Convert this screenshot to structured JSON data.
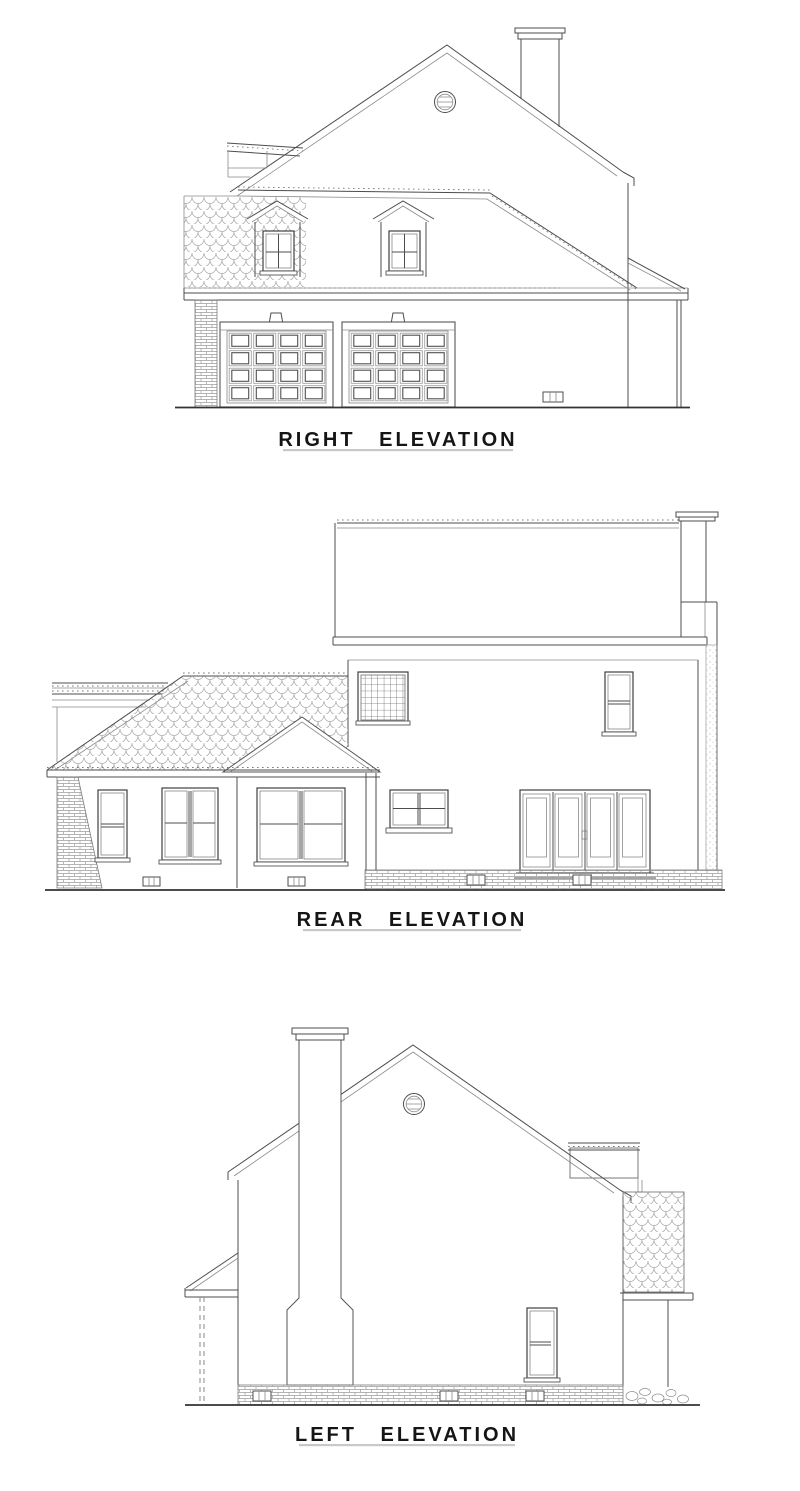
{
  "canvas": {
    "background": "#ffffff",
    "ink": "#4d4d4d",
    "accent_underline": "#c8c8c8",
    "width_px": 800,
    "height_px": 1491
  },
  "elevations": [
    {
      "id": "right",
      "label": "RIGHT ELEVATION",
      "features": [
        "main-gable-roof",
        "roof-chimney",
        "round-gable-vent",
        "shingle-roof-patch",
        "gabled-dormer",
        "gabled-dormer",
        "brick-pier",
        "garage-door",
        "garage-door",
        "foundation-vent",
        "side-porch-roof",
        "ground-line"
      ]
    },
    {
      "id": "rear",
      "label": "REAR ELEVATION",
      "features": [
        "two-story-roof",
        "exterior-chimney",
        "lattice-window",
        "double-hung-window",
        "grid-window",
        "french-doors",
        "brick-foundation",
        "hip-roof-wing",
        "gable-porch",
        "brick-pier",
        "window-pair",
        "window-pair",
        "foundation-vent",
        "ground-line"
      ]
    },
    {
      "id": "left",
      "label": "LEFT ELEVATION",
      "features": [
        "main-gable-roof",
        "tall-exterior-chimney",
        "round-gable-vent",
        "shed-dormer-side",
        "shingle-roof-side",
        "double-hung-window",
        "porch-roof",
        "porch-post-dashed",
        "brick-foundation",
        "foundation-vent",
        "stone-rubble",
        "ground-line"
      ]
    }
  ]
}
